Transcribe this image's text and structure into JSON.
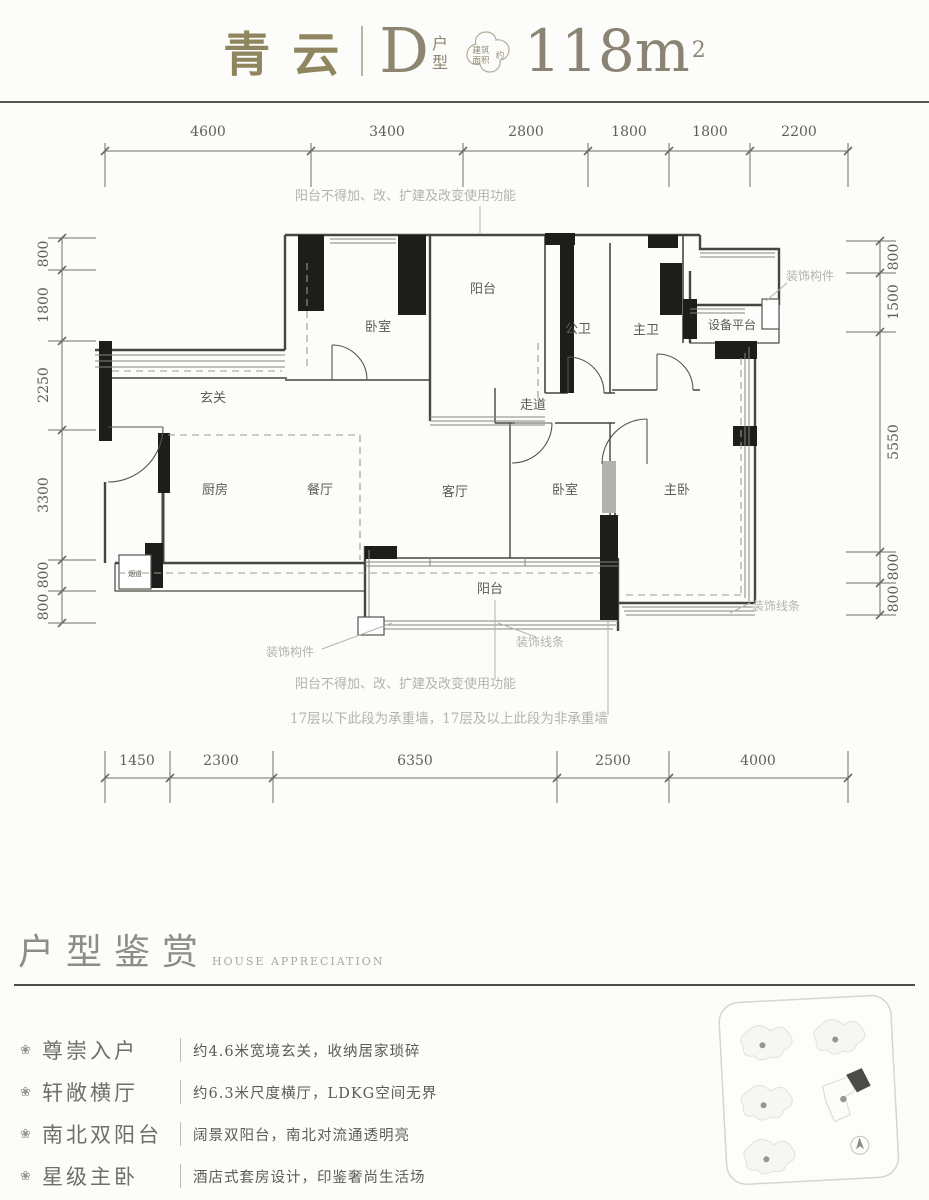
{
  "header": {
    "project_name": "青云",
    "unit_letter": "D",
    "unit_suffix_top": "户",
    "unit_suffix_bottom": "型",
    "badge_line1": "建筑",
    "badge_line2": "面积",
    "badge_approx": "约",
    "area_value": "118m",
    "area_sup": "2"
  },
  "plan": {
    "dims_top": [
      "4600",
      "3400",
      "2800",
      "1800",
      "1800",
      "2200"
    ],
    "dims_bottom": [
      "1450",
      "2300",
      "6350",
      "2500",
      "4000"
    ],
    "dims_left": [
      "800",
      "1800",
      "2250",
      "3300",
      "800",
      "800"
    ],
    "dims_right": [
      "800",
      "1500",
      "5550",
      "800",
      "800"
    ],
    "rooms": {
      "bedroom_top": "卧室",
      "balcony_top": "阳台",
      "bath_public": "公卫",
      "bath_master": "主卫",
      "equipment_platform": "设备平台",
      "corridor": "走道",
      "foyer": "玄关",
      "kitchen": "厨房",
      "dining": "餐厅",
      "living": "客厅",
      "bedroom_mid": "卧室",
      "master_bedroom": "主卧",
      "balcony_bottom": "阳台",
      "flue": "烟道"
    },
    "notes": {
      "balcony_rule_top": "阳台不得加、改、扩建及改变使用功能",
      "balcony_rule_bottom": "阳台不得加、改、扩建及改变使用功能",
      "bearing_wall": "17层以下此段为承重墙，17层及以上此段为非承重墙",
      "deco_part_top": "装饰构件",
      "deco_part_bottom": "装饰构件",
      "deco_line_right": "装饰线条",
      "deco_line_bottom": "装饰线条"
    }
  },
  "appreciation": {
    "title": "户型鉴赏",
    "subtitle": "HOUSE APPRECIATION",
    "features": [
      {
        "icon": "flower-bullet",
        "glyph": "❀",
        "title": "尊崇入户",
        "desc": "约4.6米宽境玄关，收纳居家琐碎"
      },
      {
        "icon": "flower-bullet",
        "glyph": "❀",
        "title": "轩敞横厅",
        "desc": "约6.3米尺度横厅，LDKG空间无界"
      },
      {
        "icon": "flower-bullet",
        "glyph": "❀",
        "title": "南北双阳台",
        "desc": "阔景双阳台，南北对流通透明亮"
      },
      {
        "icon": "flower-bullet",
        "glyph": "❀",
        "title": "星级主卧",
        "desc": "酒店式套房设计，印鉴奢尚生活场"
      }
    ]
  },
  "colors": {
    "accent_bronze": "#8f865f",
    "area_bronze": "#8b8474",
    "wall_line": "#46453f",
    "note_gray": "#b4b3ac"
  }
}
